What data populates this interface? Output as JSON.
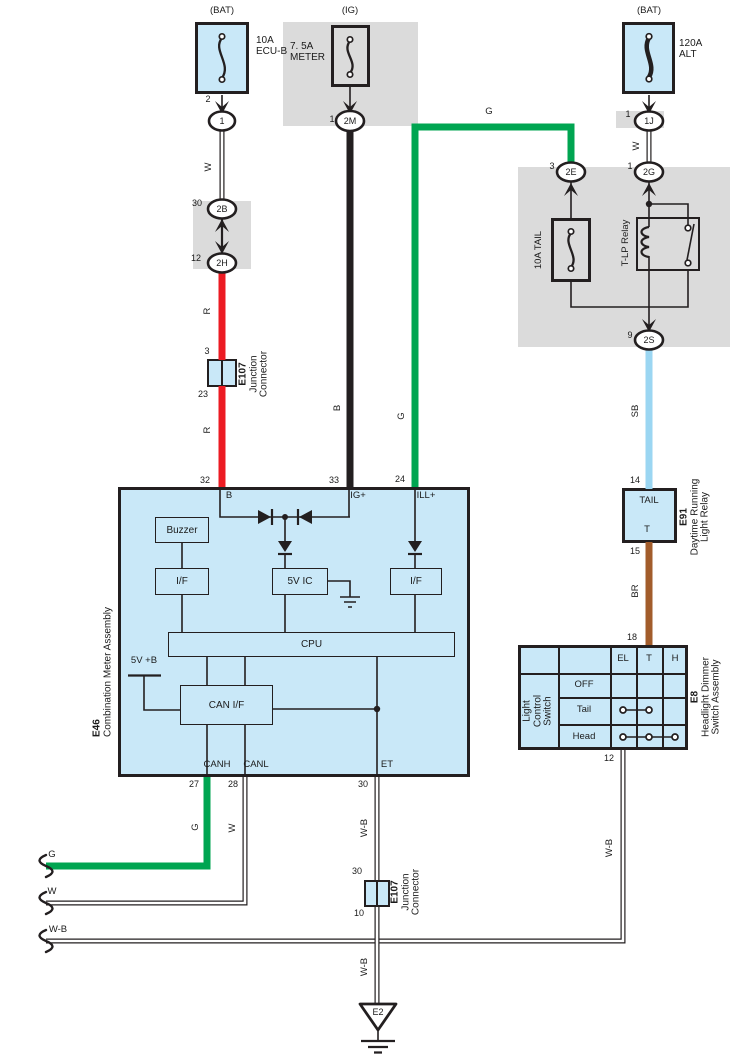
{
  "colors": {
    "green": "#00A551",
    "red": "#EC1B23",
    "wire_black": "#231F20",
    "sky_blue": "#9BD6F2",
    "brown": "#A25C2B",
    "ink": "#231F20",
    "component_fill": "#C9E8F8",
    "panel_gray": "#DBDBDB",
    "wire_white": "#FFFFFF"
  },
  "wire_labels": {
    "w": "W",
    "r": "R",
    "b": "B",
    "g": "G",
    "sb": "SB",
    "br": "BR",
    "wb": "W-B"
  },
  "power": {
    "ecub": {
      "source": "(BAT)",
      "rating": "10A",
      "name": "ECU-B",
      "pin": "2",
      "conn": "1"
    },
    "meter": {
      "source": "(IG)",
      "rating": "7. 5A",
      "name": "METER",
      "pin": "1",
      "conn": "2M"
    },
    "alt": {
      "source": "(BAT)",
      "rating": "120A",
      "name": "ALT",
      "pin": "1",
      "conn": "1J"
    }
  },
  "connectors": {
    "b2": {
      "pin": "30",
      "label": "2B"
    },
    "h2": {
      "pin": "12",
      "label": "2H"
    },
    "g2": {
      "pin": "1",
      "label": "2G"
    },
    "e2": {
      "pin": "3",
      "label": "2E"
    },
    "s2": {
      "pin": "9",
      "label": "2S"
    }
  },
  "e107": {
    "code": "E107",
    "name1": "Junction",
    "name2": "Connector",
    "a_pin_top": "3",
    "a_pin_bottom": "23",
    "b_pin_top": "30",
    "b_pin_bottom": "10"
  },
  "relay_panel": {
    "fuse": "10A TAIL",
    "relay": "T-LP Relay"
  },
  "e91": {
    "code": "E91",
    "name1": "Daytime Running",
    "name2": "Light Relay",
    "title": "TAIL",
    "terminal": "T",
    "pin_in": "14",
    "pin_out": "15"
  },
  "e8": {
    "code": "E8",
    "name1": "Headlight Dimmer",
    "name2": "Switch Assembly",
    "sw1": "Light",
    "sw2": "Control",
    "sw3": "Switch",
    "col_el": "EL",
    "col_t": "T",
    "col_h": "H",
    "row_off": "OFF",
    "row_tail": "Tail",
    "row_head": "Head",
    "pin_in": "18",
    "pin_out": "12"
  },
  "e46": {
    "code": "E46",
    "name": "Combination Meter Assembly",
    "pin32": "32",
    "pin33": "33",
    "pin24": "24",
    "pin27": "27",
    "pin28": "28",
    "pin30": "30",
    "t_b": "B",
    "t_ig": "IG+",
    "t_ill": "ILL+",
    "t_canh": "CANH",
    "t_canl": "CANL",
    "t_et": "ET",
    "buzzer": "Buzzer",
    "if_left": "I/F",
    "ic": "5V IC",
    "if_right": "I/F",
    "cpu": "CPU",
    "can_if": "CAN I/F",
    "supply": "5V +B"
  },
  "ground": {
    "code": "E2"
  }
}
